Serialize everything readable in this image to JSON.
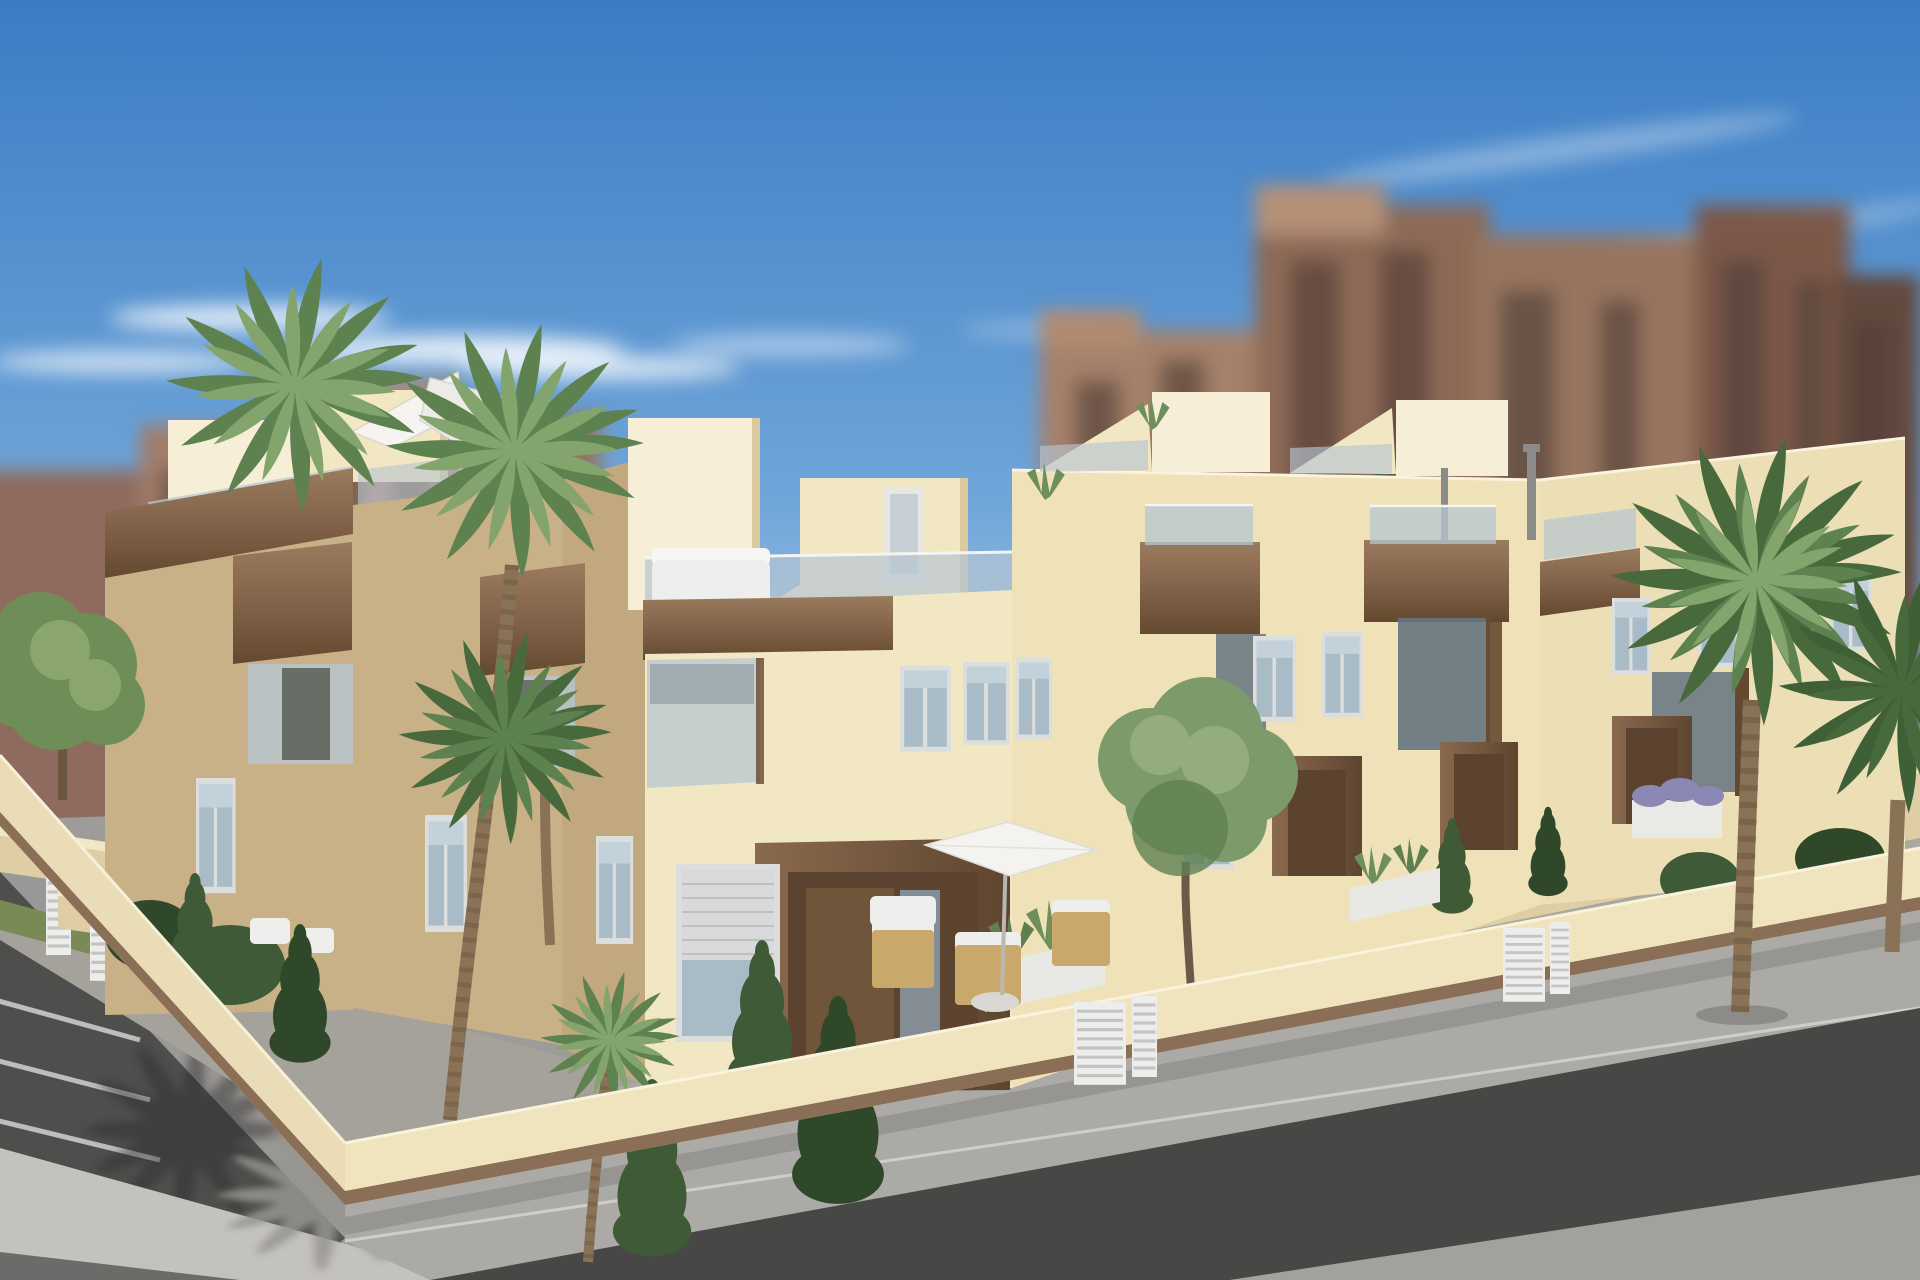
{
  "scene": {
    "type": "architectural-3d-render",
    "description": "Elevated three-quarter exterior visualization of a modern two-storey cream townhouse block on a street corner, with wood-clad balcony boxes, frameless glass balustrades, stepped roof terraces with white parasols, walled front gardens with palms, conifers and an olive tree, a cream perimeter wall with white slatted gates, grey sidewalks, dark asphalt road and parking bays; blurred earth-toned apartment towers rise behind under a blue sky with thin clouds",
    "elements": [
      "sky",
      "wispy clouds",
      "blurred background city towers",
      "townhouse block",
      "stair bulkheads",
      "roof terraces",
      "white cantilever parasol",
      "patio parasol",
      "wood fascia beams",
      "wood balcony boxes",
      "glass balustrades",
      "windows with roller shutter",
      "timber entrance portal",
      "front gardens",
      "agave planters",
      "wicker patio chairs",
      "white garden chairs",
      "perimeter wall",
      "white slatted gates",
      "palm trees",
      "olive tree",
      "conifer shrubs",
      "sidewalk",
      "asphalt road",
      "parking bays with white lines",
      "palm shadows"
    ]
  },
  "colors": {
    "sky_top": "#3A7CC4",
    "sky_mid": "#6FA5D9",
    "sky_horizon": "#C9DCEF",
    "cloud": "#FFFFFF",
    "bg_a": "#8E6B5E",
    "bg_b": "#A17D6A",
    "bg_c": "#AA8873",
    "bg_d": "#96745F",
    "bg_e": "#8D6A56",
    "bg_f": "#97745F",
    "bg_g": "#7B594A",
    "bg_h": "#644A3E",
    "bg_window": "#54403A",
    "bg_wall_light": "#D8D7D3",
    "facade_sunlit": "#F2E7C3",
    "facade_bright": "#F6EED6",
    "facade_right": "#EFE2B8",
    "facade_end": "#ECDFB6",
    "facade_shadow": "#C9B187",
    "facade_side": "#C2A87E",
    "wood": "#82634A",
    "wood_light": "#9A7B5E",
    "wood_dark": "#64492F",
    "glass": "#B7C5D1",
    "glass_dark": "#64747F",
    "window_glass": "#A9BBC7",
    "frame": "#DCDDDD",
    "shutter": "#D8D9DA",
    "door_recess": "#5C4330",
    "door_panel": "#6F5539",
    "wall_front": "#F0E4BF",
    "wall_left": "#E9DCB6",
    "wall_plinth": "#8A6E55",
    "fence_white": "#EDEEEC",
    "sidewalk": "#ACAAA7",
    "sidewalk_bright": "#C4C2BE",
    "left_sidewalk": "#9A9896",
    "asphalt": "#474846",
    "asphalt_light": "#A3A19E",
    "parking": "#4E4F4D",
    "line_white": "#D9D9D7",
    "shadow_dark": "#2A2B2A",
    "shadow_grey": "#97958F",
    "grass": "#7A8A56",
    "bush": "#3E5A36",
    "bush_dark": "#2E4829",
    "tree_green": "#6F8D56",
    "tree_light": "#8AA66C",
    "olive": "#7D9A6A",
    "olive_light": "#94AD7D",
    "palm": "#5E8150",
    "palm_light": "#83A46C",
    "palm_dark": "#47693C",
    "palm_backlit": "#3F6036",
    "trunk": "#8A7257",
    "trunk_dark": "#6B573F",
    "furniture_white": "#EEEFED",
    "wicker": "#C9A96B",
    "lavender": "#8C88B5",
    "pipe_grey": "#8B8C89",
    "ground_base": "#9E9C98",
    "yard_paving": "#ABA8A2",
    "wall_inner_top": "#F2E7C4",
    "wall_inner_face": "#DECDA5"
  }
}
